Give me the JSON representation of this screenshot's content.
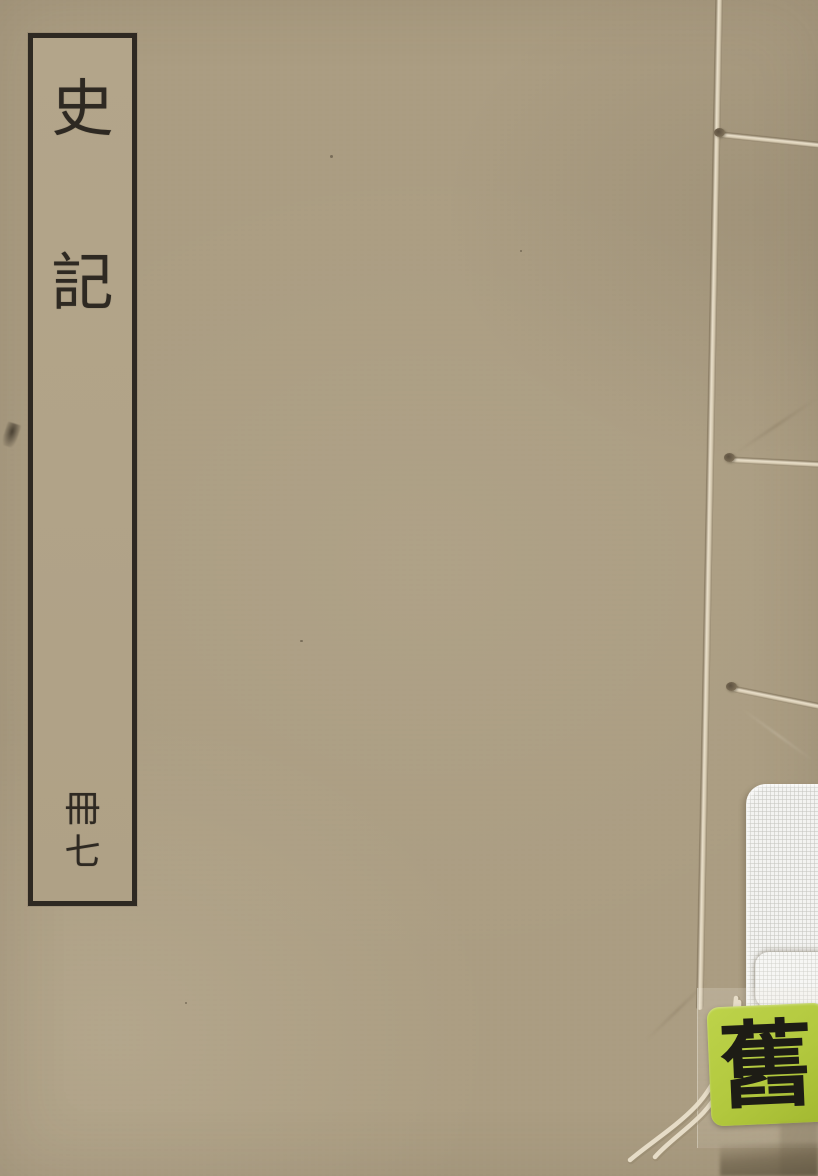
{
  "title_label": {
    "chars": [
      "史",
      "記"
    ],
    "volume_chars": [
      "冊",
      "七"
    ]
  },
  "sticker": {
    "char": "舊"
  },
  "colors": {
    "cover": "#ab9d82",
    "ink": "#2e2922",
    "label_paper": "#b2a489",
    "thread_light": "#e6dcc7",
    "thread_shadow": "#8a7c62",
    "band_white": "#f3f3f1",
    "sticker_green": "#b2c83e",
    "sticker_ink": "#1d1c15",
    "edge_shadow": "#6e6049"
  }
}
